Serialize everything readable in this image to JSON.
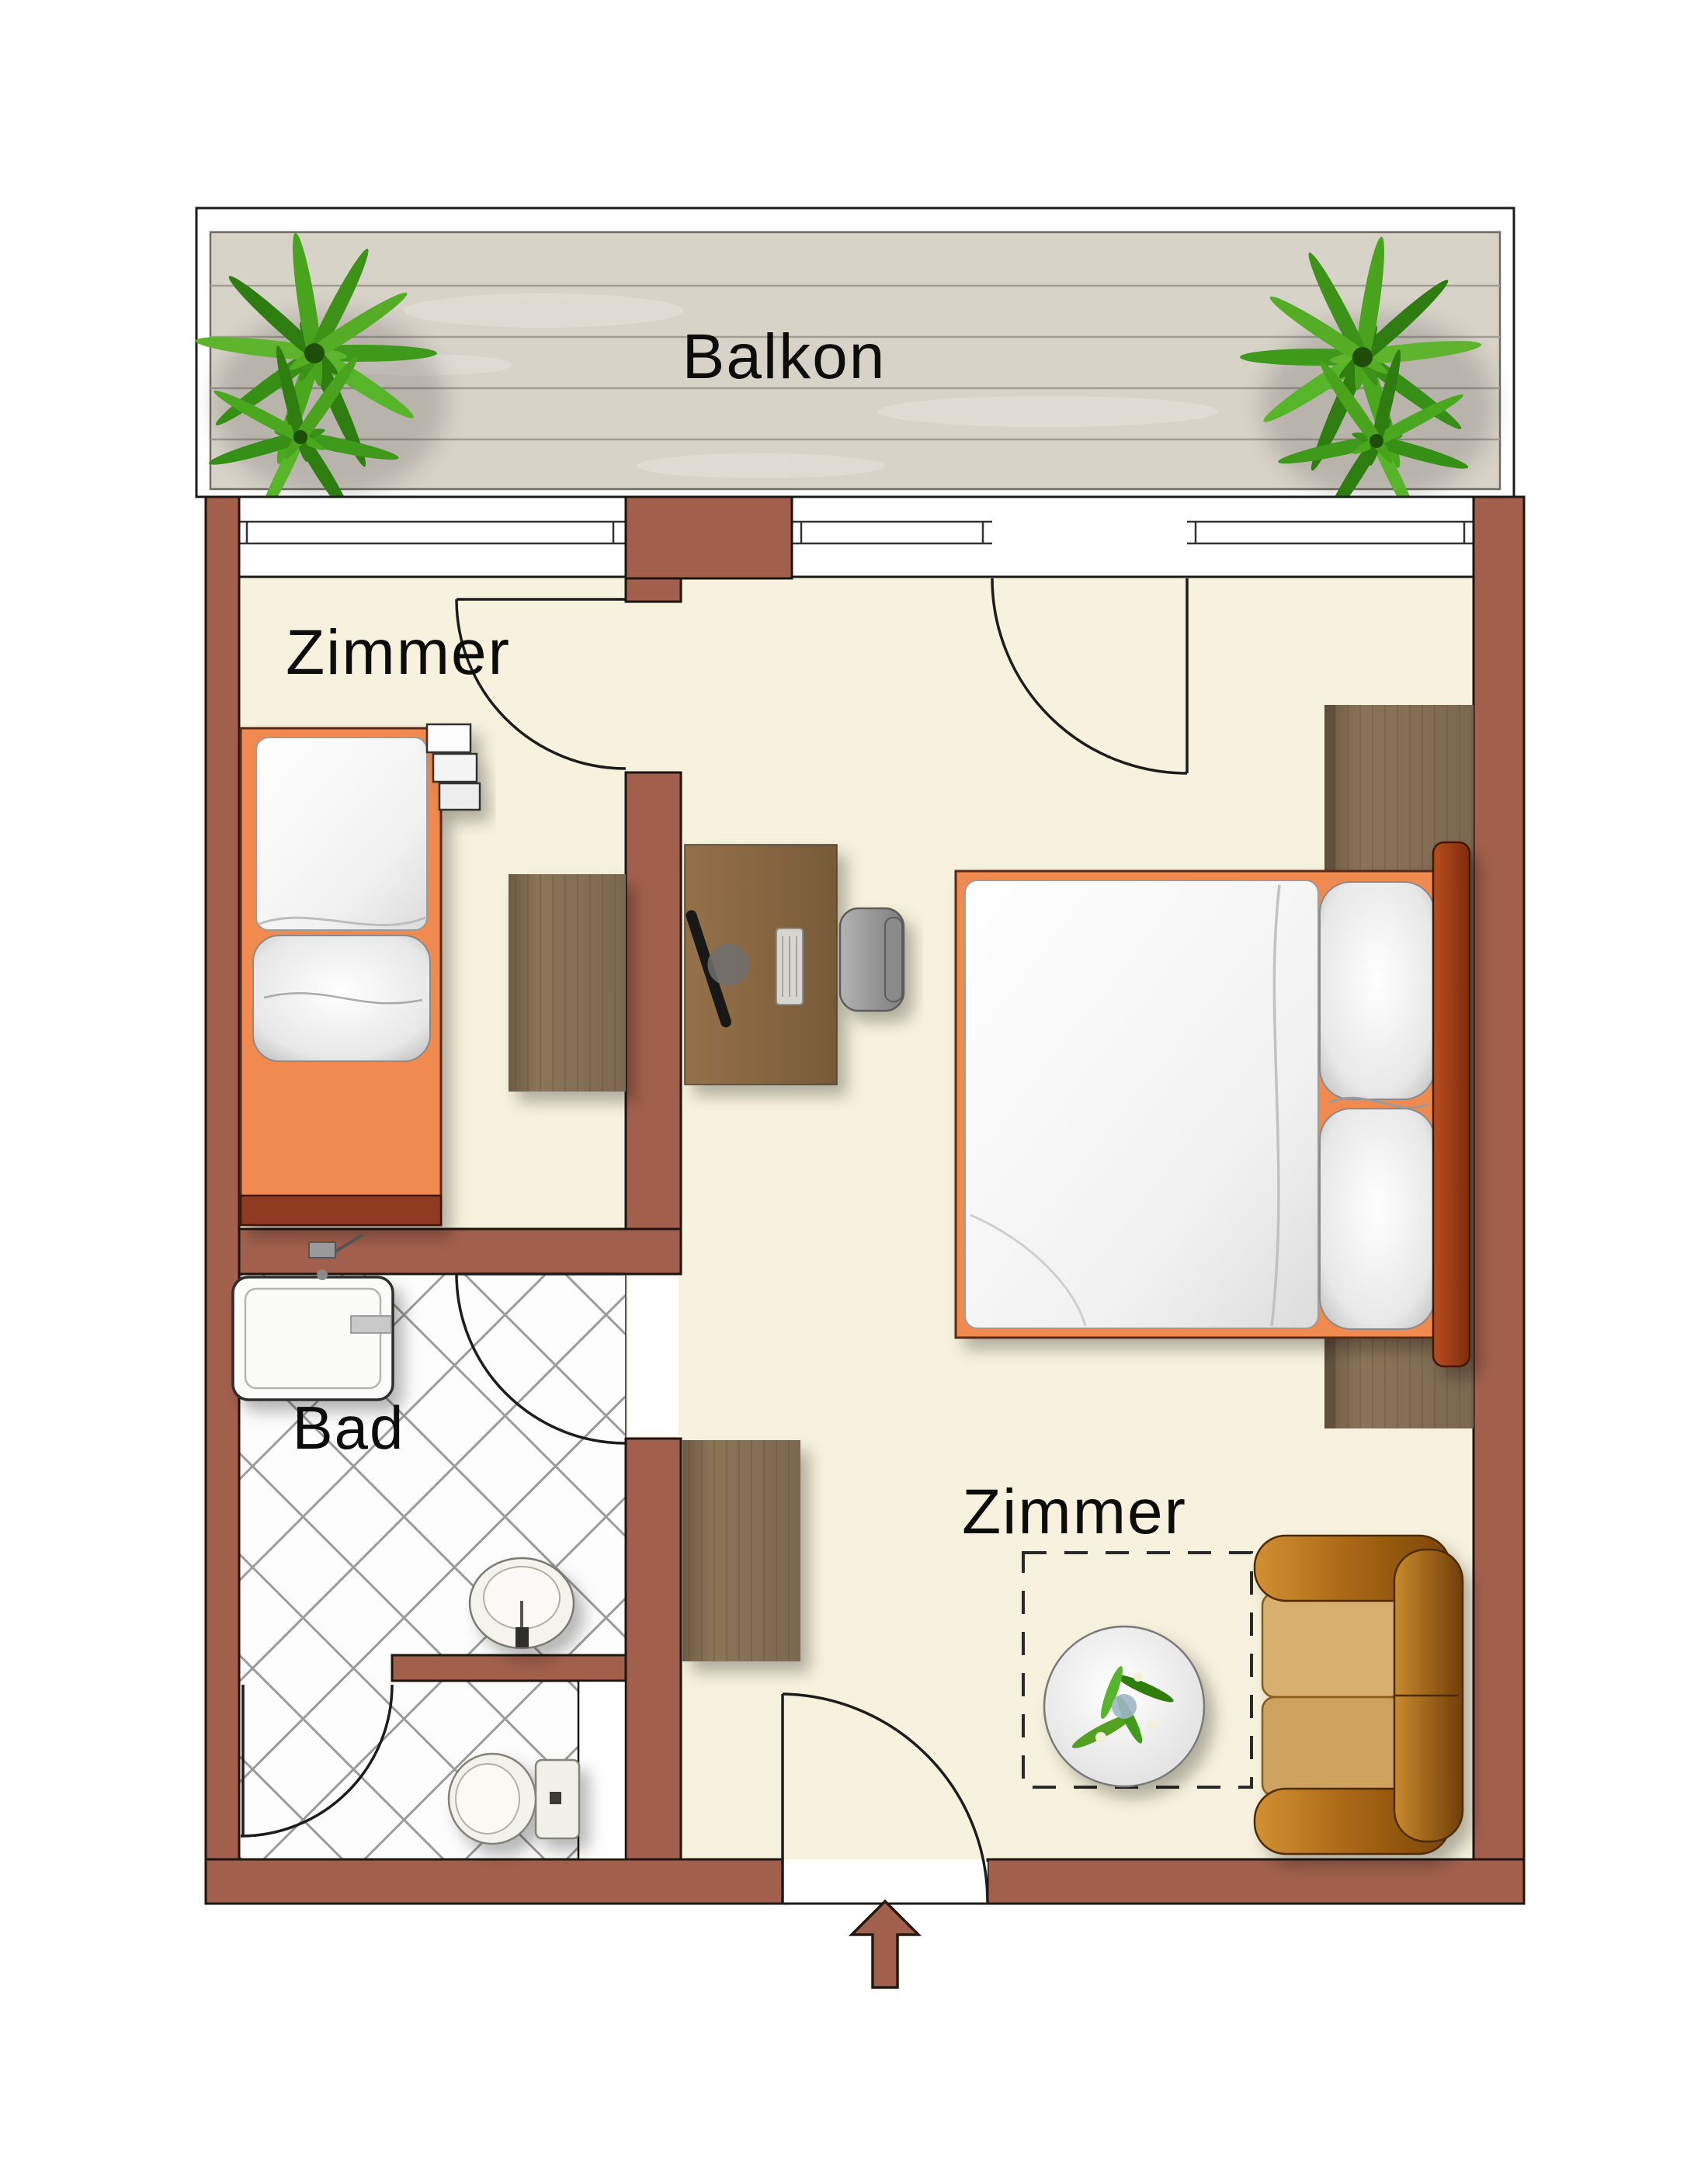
{
  "plan": {
    "labels": {
      "balcony": "Balkon",
      "room_left": "Zimmer",
      "room_main": "Zimmer",
      "bathroom": "Bad"
    },
    "colors": {
      "wall": "#a2604c",
      "outline": "#1d150f",
      "floor": "#f7f2dd",
      "deck": "#d8d3c9",
      "deck_line": "#a29d94",
      "tile_line": "#9b9b9b",
      "bed_frame_orange": "#f08a50",
      "bed_rail_red": "#8e3b20",
      "wood_desk": "#8b6c4c",
      "wood_dresser": "#7e6a50",
      "sofa_gold": "#b8741f",
      "plant_green": "#49a31d",
      "arrow": "#a2604c"
    },
    "furniture_icons": [
      "balcony-plant-icon",
      "single-bed-icon",
      "radiator-shelf-icon",
      "dresser-icon",
      "desk-icon",
      "monitor-icon",
      "keyboard-icon",
      "office-chair-icon",
      "double-bed-icon",
      "headboard-icon",
      "bed-rug-icon",
      "sideboard-icon",
      "sofa-icon",
      "coffee-table-icon",
      "table-plant-icon",
      "carpet-outline-icon",
      "shower-icon",
      "washbasin-icon",
      "toilet-icon",
      "duct-shaft-icon",
      "door-swing-icon",
      "window-icon",
      "entry-arrow-icon"
    ]
  }
}
